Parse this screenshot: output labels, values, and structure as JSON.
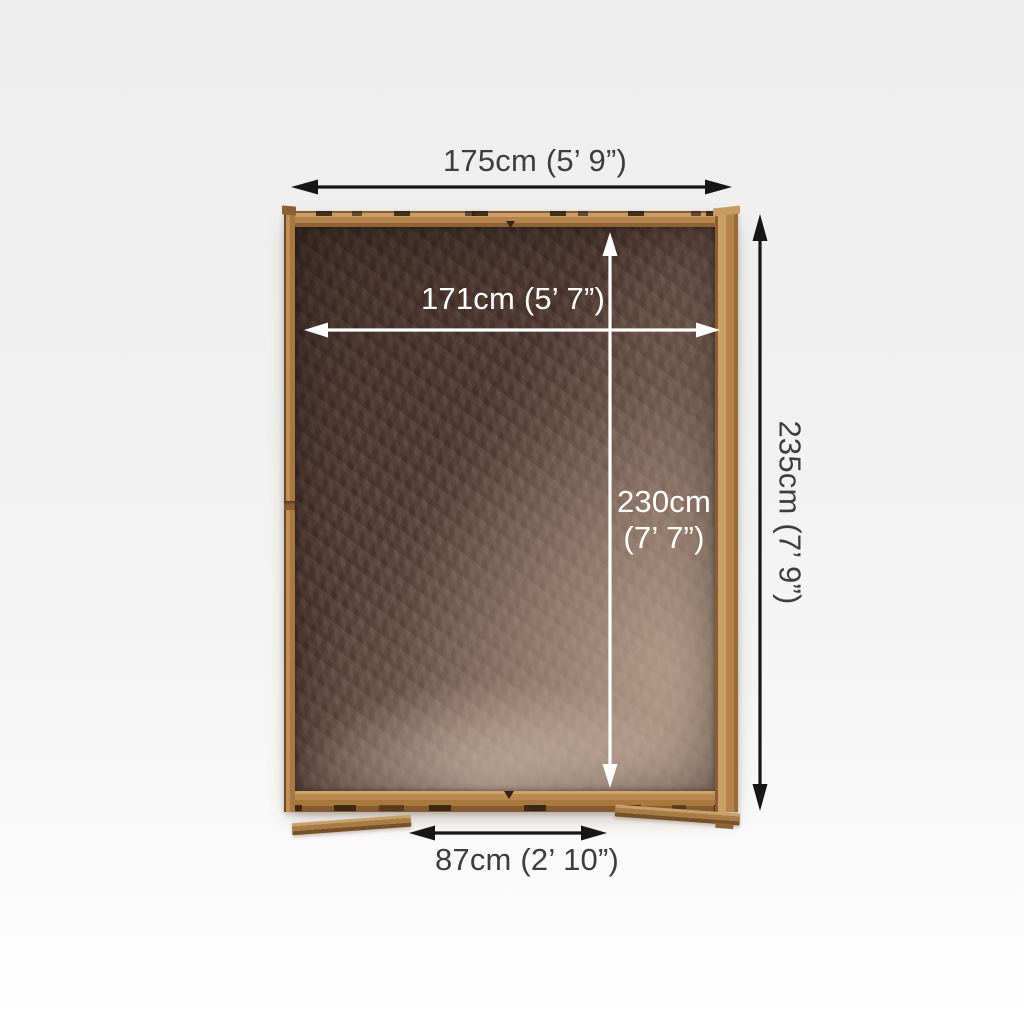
{
  "dimensions": {
    "external_width": "175cm (5’ 9”)",
    "external_depth": "235cm (7’ 9”)",
    "internal_width": "171cm (5’ 7”)",
    "internal_depth_line1": "230cm",
    "internal_depth_line2": "(7’ 7”)",
    "door_width": "87cm (2’ 10”)"
  },
  "colors": {
    "background_top": "#eeeeee",
    "background_bottom": "#ffffff",
    "label_dark": "#3d3d3d",
    "label_light": "#ffffff",
    "arrow_dark": "#161616",
    "arrow_light": "#ffffff",
    "frame_wood": "#b5834c",
    "frame_wood_dark": "#7d5731",
    "frame_wood_light": "#cfa066",
    "floor_dark": "#4e3932",
    "floor_light": "#a58b7a"
  }
}
